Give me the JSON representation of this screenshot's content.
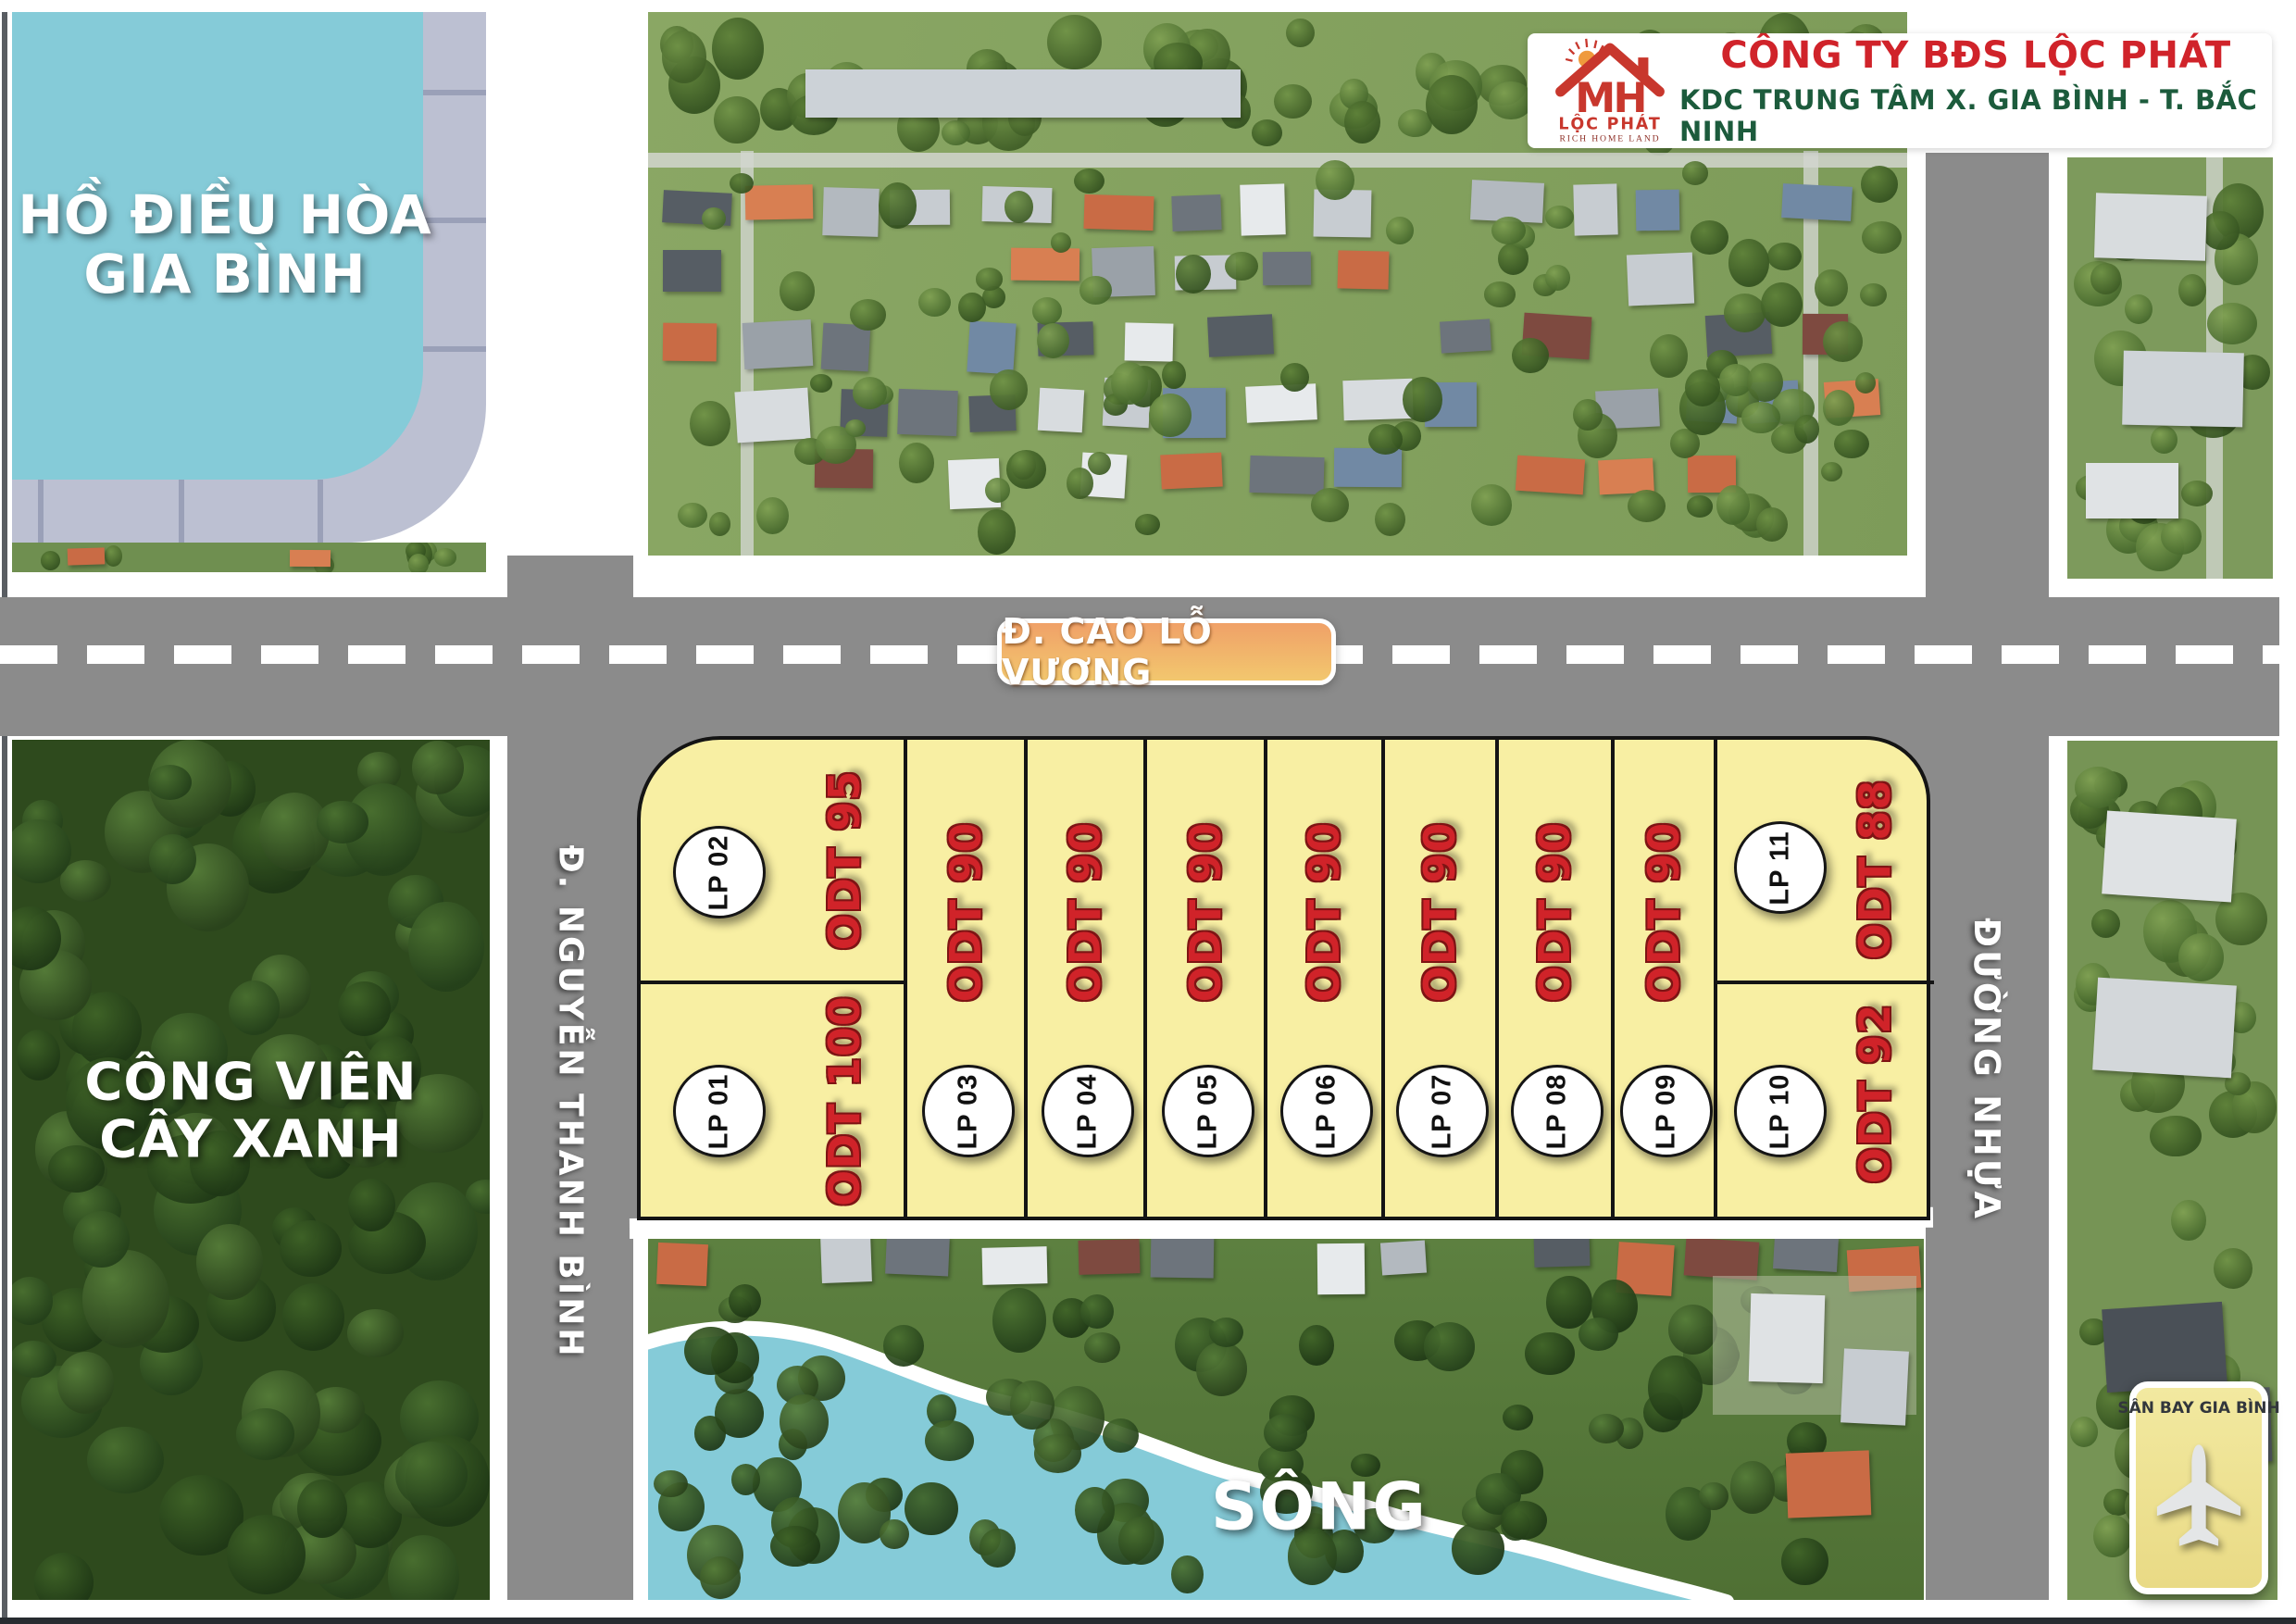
{
  "header": {
    "logo": {
      "monogram": "MH",
      "brand": "LỘC PHÁT",
      "tagline": "RICH HOME LAND"
    },
    "company": "CÔNG TY BĐS LỘC PHÁT",
    "project": "KDC TRUNG TÂM X. GIA BÌNH - T. BẮC NINH"
  },
  "roads": {
    "main": "Đ. CAO LỖ VƯƠNG",
    "left": "Đ. NGUYỄN THANH BÌNH",
    "right": "ĐƯỜNG NHỰA"
  },
  "areas": {
    "lake": [
      "HỒ ĐIỀU HÒA",
      "GIA BÌNH"
    ],
    "park": [
      "CÔNG VIÊN",
      "CÂY XANH"
    ],
    "river": "SÔNG",
    "airport": "SÂN BAY GIA BÌNH"
  },
  "plots": {
    "left_top": {
      "id": "LP 02",
      "area": "ODT 95"
    },
    "left_bottom": {
      "id": "LP 01",
      "area": "ODT 100"
    },
    "strips": [
      {
        "id": "LP 03",
        "area": "ODT 90"
      },
      {
        "id": "LP 04",
        "area": "ODT 90"
      },
      {
        "id": "LP 05",
        "area": "ODT 90"
      },
      {
        "id": "LP 06",
        "area": "ODT 90"
      },
      {
        "id": "LP 07",
        "area": "ODT 90"
      },
      {
        "id": "LP 08",
        "area": "ODT 90"
      },
      {
        "id": "LP 09",
        "area": "ODT 90"
      }
    ],
    "right_top": {
      "id": "LP 11",
      "area": "ODT 88"
    },
    "right_bottom": {
      "id": "LP 10",
      "area": "ODT 92"
    }
  },
  "colors": {
    "road": "#8B8B8B",
    "plot_fill": "#F8EFA3",
    "plot_border": "#141414",
    "plot_area_text": "#D02329",
    "water": "#85CBD8",
    "walkway": "#BCC0D2",
    "walkway_tick": "#9AA0B8",
    "forest_dark": "#33511F",
    "village_green": "#87A35F",
    "badge_orange_top": "#F0A168",
    "badge_orange_bottom": "#F2C76E",
    "brand_red": "#D0232A",
    "brand_green": "#1C5B3C",
    "airport_bg": "#EFE395"
  }
}
